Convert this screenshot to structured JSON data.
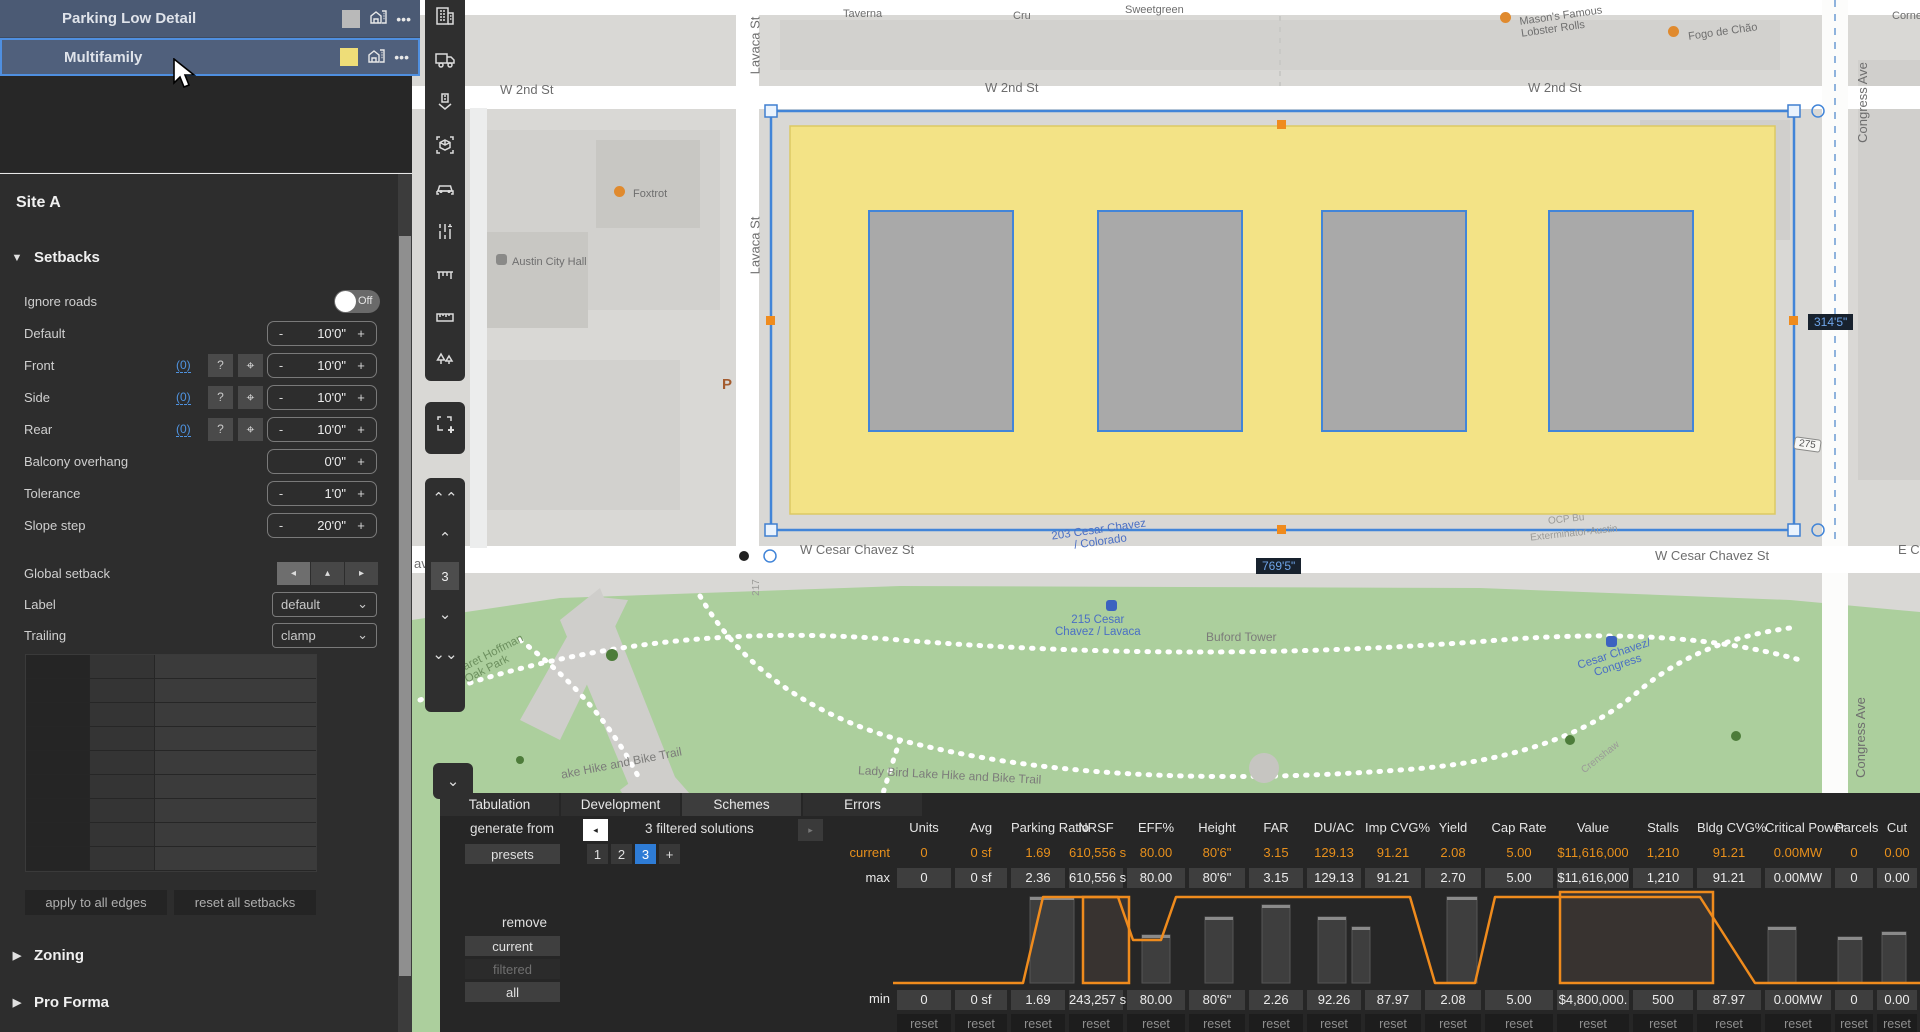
{
  "layers": {
    "rows": [
      {
        "name": "Parking Low Detail",
        "swatch": "#b9b9b9",
        "selected": false
      },
      {
        "name": "Multifamily",
        "swatch": "#eedd78",
        "selected": true
      }
    ],
    "row_icons": {
      "building": "building-icon",
      "menu": "•••"
    }
  },
  "sidebar": {
    "site_title": "Site A",
    "setbacks": {
      "header": "Setbacks",
      "collapse_glyph": "▼",
      "rows": [
        {
          "label": "Ignore roads",
          "type": "toggle",
          "value": "Off"
        },
        {
          "label": "Default",
          "type": "stepper",
          "minus": "-",
          "value": "10'0\"",
          "plus": "+"
        },
        {
          "label": "Front",
          "type": "stepper-link",
          "link": "(0)",
          "help": "?",
          "minus": "-",
          "value": "10'0\"",
          "plus": "+"
        },
        {
          "label": "Side",
          "type": "stepper-link",
          "link": "(0)",
          "help": "?",
          "minus": "-",
          "value": "10'0\"",
          "plus": "+"
        },
        {
          "label": "Rear",
          "type": "stepper-link",
          "link": "(0)",
          "help": "?",
          "minus": "-",
          "value": "10'0\"",
          "plus": "+"
        },
        {
          "label": "Balcony overhang",
          "type": "stepper",
          "minus": "",
          "value": "0'0\"",
          "plus": "+"
        },
        {
          "label": "Tolerance",
          "type": "stepper",
          "minus": "-",
          "value": "1'0\"",
          "plus": "+"
        },
        {
          "label": "Slope step",
          "type": "stepper",
          "minus": "-",
          "value": "20'0\"",
          "plus": "+"
        }
      ],
      "global_setback": {
        "label": "Global setback",
        "buttons": [
          "◂",
          "▴",
          "▸"
        ]
      },
      "label_row": {
        "label": "Label",
        "value": "default"
      },
      "trailing_row": {
        "label": "Trailing",
        "value": "clamp"
      },
      "apply_btn": "apply to all edges",
      "reset_btn": "reset all setbacks"
    },
    "sections": [
      {
        "label": "Zoning",
        "glyph": "▶"
      },
      {
        "label": "Pro Forma",
        "glyph": "▶"
      }
    ]
  },
  "toolbar": {
    "icons": [
      "office-building-icon",
      "truck-icon",
      "place-building-icon",
      "focus-3d-box-icon",
      "car-icon",
      "lanes-adjust-icon",
      "bench-icon",
      "ruler-icon",
      "trees-icon"
    ],
    "marquee_icon": "marquee-add-icon",
    "level_switcher": {
      "up_fast": "«",
      "up": "⌃",
      "level": "3",
      "down": "⌄",
      "down_fast": "»"
    },
    "collapse_chevron": "⌄"
  },
  "map": {
    "selection_dims": {
      "width_label": "769'5\"",
      "height_label": "314'5\""
    },
    "street_labels": [
      {
        "text": "W 2nd St",
        "x": 500,
        "y": 82
      },
      {
        "text": "W 2nd St",
        "x": 985,
        "y": 80
      },
      {
        "text": "W 2nd St",
        "x": 1528,
        "y": 80
      },
      {
        "text": "Lavaca St",
        "x": 726,
        "y": 38,
        "rot": -90
      },
      {
        "text": "Lavaca St",
        "x": 726,
        "y": 238,
        "rot": -90
      },
      {
        "text": "Congress Ave",
        "x": 1822,
        "y": 95,
        "rot": -90
      },
      {
        "text": "Congress Ave",
        "x": 1820,
        "y": 730,
        "rot": -90
      },
      {
        "text": "W Cesar Chavez St",
        "x": 800,
        "y": 542
      },
      {
        "text": "W Cesar Chavez St",
        "x": 1655,
        "y": 548
      },
      {
        "text": "E Ce",
        "x": 1898,
        "y": 542
      },
      {
        "text": "avez St",
        "x": 414,
        "y": 556
      }
    ],
    "poi_labels": [
      {
        "text": "Taverna",
        "x": 843,
        "y": 8,
        "cls": "small"
      },
      {
        "text": "Cru",
        "x": 1013,
        "y": 10,
        "cls": "small"
      },
      {
        "text": "Sweetgreen",
        "x": 1125,
        "y": 4,
        "cls": "small"
      },
      {
        "text": "Mason's Famous\nLobster Rolls",
        "x": 1520,
        "y": 10,
        "cls": "small",
        "rot": -8
      },
      {
        "text": "Fogo de Chão",
        "x": 1688,
        "y": 26,
        "cls": "small",
        "rot": -8
      },
      {
        "text": "Corne",
        "x": 1892,
        "y": 10,
        "cls": "small"
      },
      {
        "text": "Foxtrot",
        "x": 633,
        "y": 188,
        "cls": "small"
      },
      {
        "text": "Austin City Hall",
        "x": 512,
        "y": 256,
        "cls": "small"
      },
      {
        "text": "203 Cesar Chavez\n/ Colorado",
        "x": 1052,
        "y": 524,
        "cls": "blue",
        "rot": -8
      },
      {
        "text": "215 Cesar\nChavez / Lavaca",
        "x": 1055,
        "y": 614,
        "cls": "blue"
      },
      {
        "text": "Buford Tower",
        "x": 1206,
        "y": 630,
        "cls": "trail"
      },
      {
        "text": "Cesar Chavez/\nCongress",
        "x": 1578,
        "y": 648,
        "cls": "blue",
        "rot": -18
      },
      {
        "text": "Margaret Hoffman\nOak Park",
        "x": 438,
        "y": 652,
        "cls": "green",
        "rot": -27
      },
      {
        "text": "ake Hike and Bike Trail",
        "x": 560,
        "y": 756,
        "cls": "trail",
        "rot": -11
      },
      {
        "text": "Lady Bird Lake Hike and Bike Trail",
        "x": 858,
        "y": 768,
        "cls": "trail",
        "rot": 3
      },
      {
        "text": "Exterminator-Austin",
        "x": 1530,
        "y": 528,
        "cls": "faint",
        "rot": -6
      },
      {
        "text": "OCP Bu",
        "x": 1548,
        "y": 514,
        "cls": "faint",
        "rot": -6
      },
      {
        "text": "Crenshaw",
        "x": 1578,
        "y": 752,
        "cls": "faint",
        "rot": -38
      },
      {
        "text": "217",
        "x": 748,
        "y": 582,
        "cls": "faint",
        "rot": -90
      }
    ],
    "parking_glyph": "P",
    "route_shield": "275"
  },
  "bottom_panel": {
    "tabs": [
      {
        "label": "Tabulation",
        "active": false
      },
      {
        "label": "Development",
        "active": false
      },
      {
        "label": "Schemes",
        "active": true
      },
      {
        "label": "Errors",
        "active": false
      }
    ],
    "generate_from": "generate from",
    "solutions_text": "3 filtered solutions",
    "prev_glyph": "◂",
    "next_glyph": "▸",
    "presets": "presets",
    "scheme_numbers": [
      "1",
      "2",
      "3"
    ],
    "selected_scheme": "3",
    "add_scheme": "+",
    "remove": "remove",
    "remove_current": "current",
    "remove_filtered": "filtered",
    "remove_all": "all",
    "row_labels": {
      "current": "current",
      "max": "max",
      "min": "min"
    },
    "reset_label": "reset",
    "accent_orange": "#e8901c",
    "table": {
      "columns": [
        {
          "h": "Units",
          "w": 58,
          "cur": "0",
          "max": "0",
          "min": "0"
        },
        {
          "h": "Avg",
          "w": 56,
          "cur": "0 sf",
          "max": "0 sf",
          "min": "0 sf"
        },
        {
          "h": "Parking Ratio",
          "w": 58,
          "cur": "1.69",
          "max": "2.36",
          "min": "1.69"
        },
        {
          "h": "NRSF",
          "w": 58,
          "cur": "610,556 s",
          "max": "610,556 s",
          "min": "243,257 s"
        },
        {
          "h": "EFF%",
          "w": 62,
          "cur": "80.00",
          "max": "80.00",
          "min": "80.00"
        },
        {
          "h": "Height",
          "w": 60,
          "cur": "80'6\"",
          "max": "80'6\"",
          "min": "80'6\""
        },
        {
          "h": "FAR",
          "w": 58,
          "cur": "3.15",
          "max": "3.15",
          "min": "2.26"
        },
        {
          "h": "DU/AC",
          "w": 58,
          "cur": "129.13",
          "max": "129.13",
          "min": "92.26"
        },
        {
          "h": "Imp CVG%",
          "w": 60,
          "cur": "91.21",
          "max": "91.21",
          "min": "87.97"
        },
        {
          "h": "Yield",
          "w": 60,
          "cur": "2.08",
          "max": "2.70",
          "min": "2.08"
        },
        {
          "h": "Cap Rate",
          "w": 72,
          "cur": "5.00",
          "max": "5.00",
          "min": "5.00"
        },
        {
          "h": "Value",
          "w": 76,
          "cur": "$11,616,000",
          "max": "$11,616,000",
          "min": "$4,800,000."
        },
        {
          "h": "Stalls",
          "w": 64,
          "cur": "1,210",
          "max": "1,210",
          "min": "500"
        },
        {
          "h": "Bldg CVG%",
          "w": 68,
          "cur": "91.21",
          "max": "91.21",
          "min": "87.97"
        },
        {
          "h": "Critical Power",
          "w": 70,
          "cur": "0.00MW",
          "max": "0.00MW",
          "min": "0.00MW"
        },
        {
          "h": "Parcels",
          "w": 42,
          "cur": "0",
          "max": "0",
          "min": "0"
        },
        {
          "h": "Cut",
          "w": 44,
          "cur": "0.00",
          "max": "0.00",
          "min": "0.00"
        }
      ]
    },
    "chart_data": {
      "type": "range-line",
      "note": "orange current-value line across solver ranges; y0=top(max) y93=bottom(min)",
      "viewport": [
        1027,
        100
      ],
      "polyline": [
        [
          0,
          93
        ],
        [
          130,
          93
        ],
        [
          150,
          7
        ],
        [
          225,
          7
        ],
        [
          240,
          50
        ],
        [
          268,
          50
        ],
        [
          283,
          7
        ],
        [
          517,
          7
        ],
        [
          542,
          93
        ],
        [
          582,
          93
        ],
        [
          602,
          7
        ],
        [
          807,
          7
        ],
        [
          862,
          93
        ],
        [
          1027,
          93
        ]
      ],
      "bars": [
        {
          "x": 137,
          "w": 44,
          "y": 7,
          "style": "gray"
        },
        {
          "x": 190,
          "w": 46,
          "y": 7,
          "style": "orange"
        },
        {
          "x": 249,
          "w": 28,
          "y": 45,
          "style": "gray"
        },
        {
          "x": 312,
          "w": 28,
          "y": 27,
          "style": "gray"
        },
        {
          "x": 369,
          "w": 28,
          "y": 15,
          "style": "gray"
        },
        {
          "x": 425,
          "w": 28,
          "y": 27,
          "style": "gray"
        },
        {
          "x": 459,
          "w": 18,
          "y": 37,
          "style": "gray"
        },
        {
          "x": 554,
          "w": 30,
          "y": 7,
          "style": "gray"
        },
        {
          "x": 667,
          "w": 153,
          "y": 2,
          "style": "orange"
        },
        {
          "x": 875,
          "w": 28,
          "y": 37,
          "style": "gray"
        },
        {
          "x": 945,
          "w": 24,
          "y": 47,
          "style": "gray"
        },
        {
          "x": 989,
          "w": 24,
          "y": 42,
          "style": "gray"
        }
      ]
    }
  }
}
